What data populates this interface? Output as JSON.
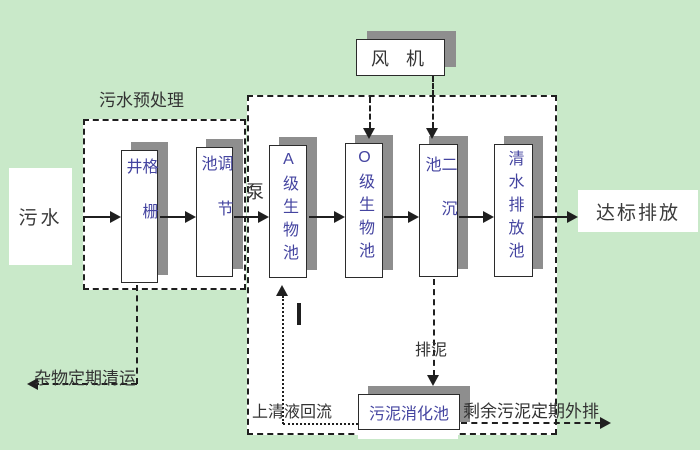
{
  "colors": {
    "bg": "#c9e9c9",
    "shadow": "#8e8e8e",
    "ink": "#1f1f1f",
    "tanktext": "#4444a0",
    "label": "#333333"
  },
  "labels": {
    "source": "污水",
    "pretreat_group": "污水预处理",
    "grid_well": "格栅井",
    "regulating": "调节池",
    "pump": "泵",
    "blower": "风 机",
    "tank_a": "A级生物池",
    "tank_o": "O级生物池",
    "secondary_sedimentation": "二沉池",
    "clear_water_discharge": "清水排放池",
    "outfall": "达标排放",
    "waste_removal": "杂物定期清运",
    "supernatant_return": "上清液回流",
    "sludge_discharge": "排泥",
    "sludge_digestion": "污泥消化池",
    "surplus_sludge_out": "剩余污泥定期外排"
  }
}
